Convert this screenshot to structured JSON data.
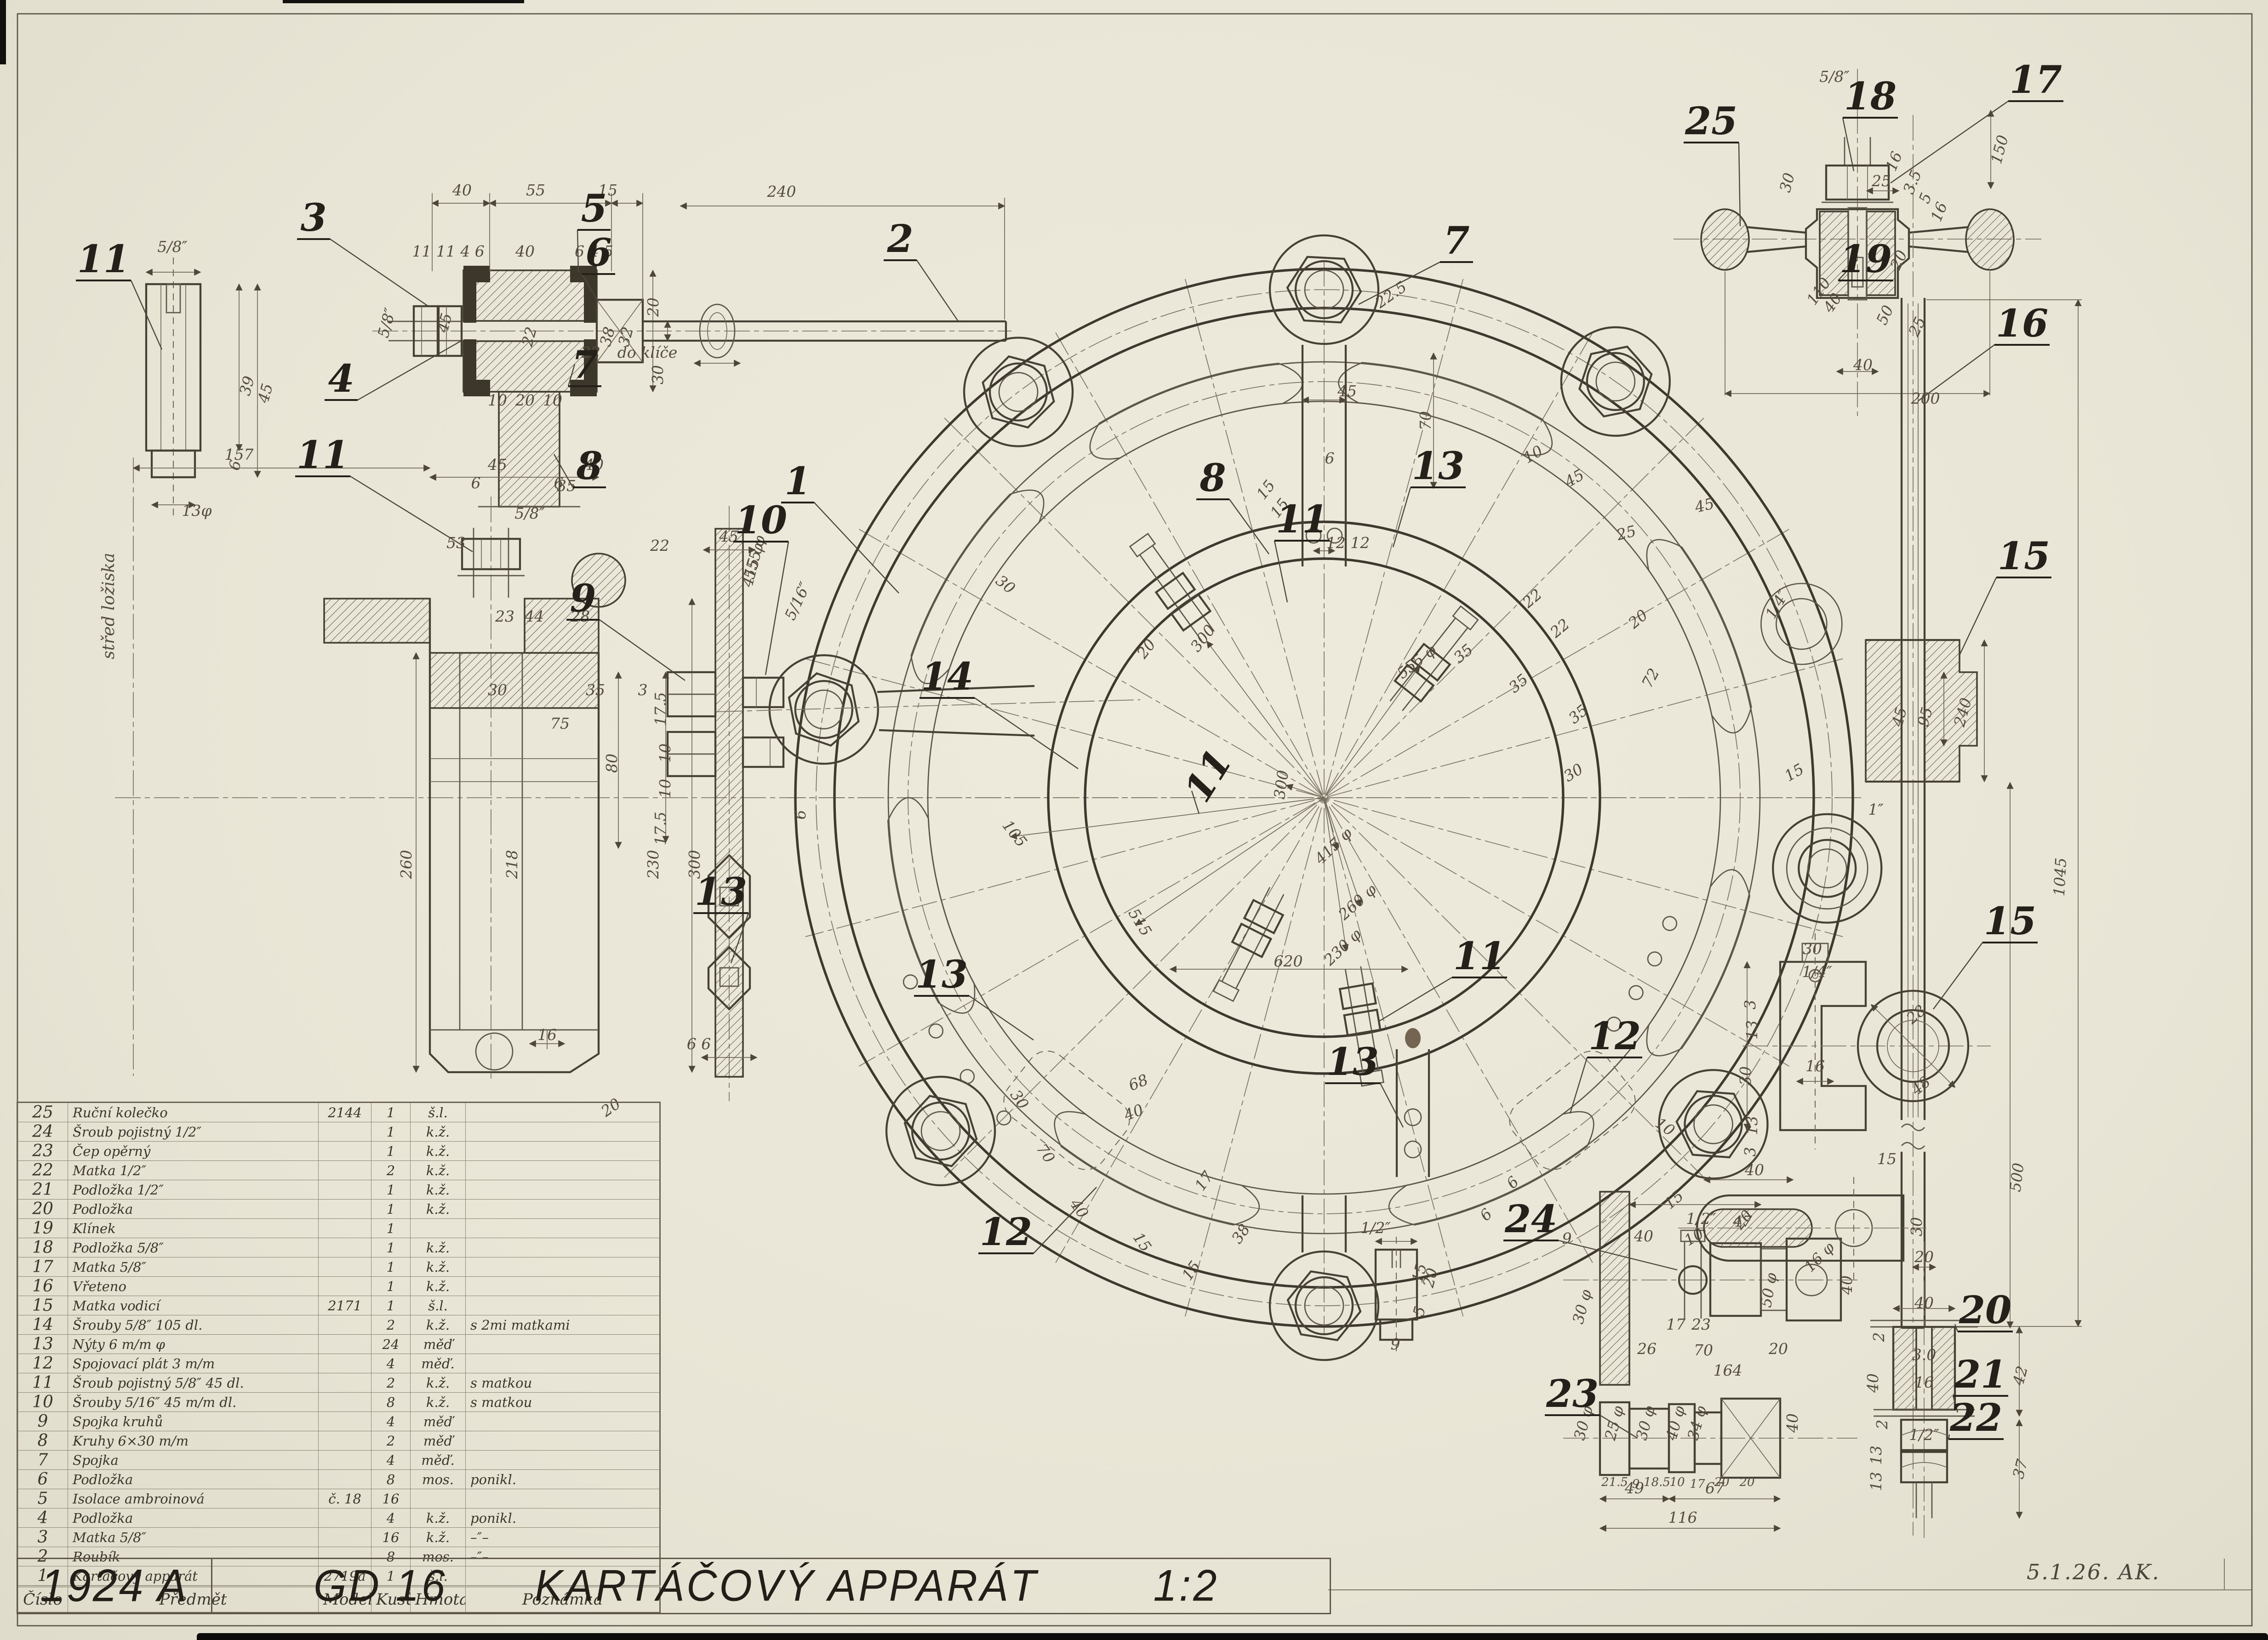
{
  "sheet": {
    "drawing_number": "1924 A",
    "model_code": "GD 16",
    "title": "KARTÁČOVÝ APPARÁT",
    "scale": "1:2",
    "signature": "5.1.26. AK."
  },
  "table": {
    "headers": [
      "Číslo",
      "Předmět",
      "Model",
      "Kusů",
      "Hmota",
      "Poznámka"
    ],
    "rows": [
      [
        "25",
        "Ruční kolečko",
        "2144",
        "1",
        "š.l.",
        ""
      ],
      [
        "24",
        "Šroub pojistný  1/2″",
        "",
        "1",
        "k.ž.",
        ""
      ],
      [
        "23",
        "Čep opěrný",
        "",
        "1",
        "k.ž.",
        ""
      ],
      [
        "22",
        "Matka  1/2″",
        "",
        "2",
        "k.ž.",
        ""
      ],
      [
        "21",
        "Podložka  1/2″",
        "",
        "1",
        "k.ž.",
        ""
      ],
      [
        "20",
        "Podložka",
        "",
        "1",
        "k.ž.",
        ""
      ],
      [
        "19",
        "Klínek",
        "",
        "1",
        "",
        ""
      ],
      [
        "18",
        "Podložka  5/8″",
        "",
        "1",
        "k.ž.",
        ""
      ],
      [
        "17",
        "Matka  5/8″",
        "",
        "1",
        "k.ž.",
        ""
      ],
      [
        "16",
        "Vřeteno",
        "",
        "1",
        "k.ž.",
        ""
      ],
      [
        "15",
        "Matka vodicí",
        "2171",
        "1",
        "š.l.",
        ""
      ],
      [
        "14",
        "Šrouby  5/8″  105 dl.",
        "",
        "2",
        "k.ž.",
        "s 2mi matkami"
      ],
      [
        "13",
        "Nýty  6 m/m φ",
        "",
        "24",
        "měď",
        ""
      ],
      [
        "12",
        "Spojovací plát  3 m/m",
        "",
        "4",
        "měď.",
        ""
      ],
      [
        "11",
        "Šroub pojistný  5/8″  45 dl.",
        "",
        "2",
        "k.ž.",
        "s matkou"
      ],
      [
        "10",
        "Šrouby  5/16″  45 m/m dl.",
        "",
        "8",
        "k.ž.",
        "s matkou"
      ],
      [
        "9",
        "Spojka kruhů",
        "",
        "4",
        "měď",
        ""
      ],
      [
        "8",
        "Kruhy  6×30 m/m",
        "",
        "2",
        "měď",
        ""
      ],
      [
        "7",
        "Spojka",
        "",
        "4",
        "měď.",
        ""
      ],
      [
        "6",
        "Podložka",
        "",
        "8",
        "mos.",
        "ponikl."
      ],
      [
        "5",
        "Isolace ambroinová",
        "č. 18",
        "16",
        "",
        ""
      ],
      [
        "4",
        "Podložka",
        "",
        "4",
        "k.ž.",
        "ponikl."
      ],
      [
        "3",
        "Matka  5/8″",
        "",
        "16",
        "k.ž.",
        "–″–"
      ],
      [
        "2",
        "Roubík",
        "",
        "8",
        "mos.",
        "–″–"
      ],
      [
        "1",
        "Kartáčový apparát",
        "2719a",
        "1",
        "š.l.",
        ""
      ]
    ]
  },
  "callouts": [
    [
      "11",
      225,
      592,
      0,
      352,
      760
    ],
    [
      "3",
      682,
      502,
      0,
      930,
      665
    ],
    [
      "5",
      1292,
      482,
      0,
      1258,
      592
    ],
    [
      "6",
      1302,
      578,
      0,
      1300,
      655
    ],
    [
      "4",
      742,
      852,
      0,
      1002,
      742
    ],
    [
      "7",
      1272,
      822,
      0,
      1250,
      792
    ],
    [
      "8",
      1282,
      1042,
      0,
      1205,
      988
    ],
    [
      "2",
      1958,
      548,
      0,
      2085,
      700
    ],
    [
      "11",
      702,
      1018,
      0,
      1028,
      1200
    ],
    [
      "9",
      1268,
      1330,
      0,
      1490,
      1480
    ],
    [
      "10",
      1655,
      1160,
      0,
      1665,
      1468
    ],
    [
      "13",
      1568,
      1968,
      0,
      1590,
      2095
    ],
    [
      "1",
      1735,
      1075,
      0,
      1955,
      1290
    ],
    [
      "7",
      3168,
      552,
      0,
      2955,
      662
    ],
    [
      "8",
      2638,
      1068,
      0,
      2760,
      1205
    ],
    [
      "13",
      3128,
      1042,
      0,
      3030,
      1190
    ],
    [
      "11",
      2832,
      1158,
      0,
      2800,
      1310
    ],
    [
      "14",
      2060,
      1500,
      0,
      2345,
      1672
    ],
    [
      "13",
      2048,
      2148,
      0,
      2248,
      2262
    ],
    [
      "11",
      2652,
      1702,
      -58,
      2608,
      1770
    ],
    [
      "12",
      2188,
      2708,
      0,
      2385,
      2582
    ],
    [
      "13",
      2942,
      2338,
      0,
      3052,
      2452
    ],
    [
      "12",
      3512,
      2282,
      0,
      3415,
      2422
    ],
    [
      "11",
      3218,
      2108,
      0,
      2998,
      2222
    ],
    [
      "25",
      3722,
      292,
      0,
      3785,
      492
    ],
    [
      "18",
      4068,
      238,
      0,
      4032,
      372
    ],
    [
      "17",
      4428,
      202,
      0,
      4112,
      398
    ],
    [
      "19",
      4058,
      592,
      0,
      4040,
      565
    ],
    [
      "16",
      4398,
      732,
      0,
      4172,
      872
    ],
    [
      "15",
      4402,
      1238,
      0,
      4262,
      1425
    ],
    [
      "15",
      4372,
      2032,
      0,
      4205,
      2195
    ],
    [
      "24",
      3330,
      2680,
      0,
      3648,
      2762
    ],
    [
      "23",
      3420,
      3060,
      0,
      3562,
      3128
    ],
    [
      "20",
      4318,
      2878,
      0,
      4252,
      2880
    ],
    [
      "21",
      4308,
      3018,
      0,
      4258,
      3072
    ],
    [
      "22",
      4298,
      3112,
      0,
      4240,
      3120
    ]
  ],
  "dims": [
    [
      "40",
      1005,
      425,
      0
    ],
    [
      "55",
      1165,
      425,
      0
    ],
    [
      "15",
      1322,
      425,
      0
    ],
    [
      "11 11 4 6",
      975,
      558,
      0
    ],
    [
      "40",
      1142,
      558,
      0
    ],
    [
      "6 4 5",
      1292,
      558,
      0
    ],
    [
      "5/8″",
      852,
      705,
      -75
    ],
    [
      "45",
      978,
      705,
      -75
    ],
    [
      "22",
      1162,
      735,
      -75
    ],
    [
      "38",
      1332,
      735,
      -75
    ],
    [
      "32",
      1372,
      735,
      -75
    ],
    [
      "30",
      1442,
      815,
      -90
    ],
    [
      "10",
      1082,
      882,
      0
    ],
    [
      "20",
      1142,
      882,
      0
    ],
    [
      "10",
      1202,
      882,
      0
    ],
    [
      "6",
      1035,
      1062,
      0
    ],
    [
      "6",
      1215,
      1062,
      0
    ],
    [
      "5/8″",
      375,
      548,
      0
    ],
    [
      "39",
      548,
      842,
      -75
    ],
    [
      "45",
      588,
      858,
      -75
    ],
    [
      "6",
      522,
      1015,
      -75
    ],
    [
      "13φ",
      428,
      1122,
      0
    ],
    [
      "240",
      1700,
      428,
      0
    ],
    [
      "20",
      1432,
      668,
      -90
    ],
    [
      "22",
      1285,
      778,
      0
    ],
    [
      "do klíče",
      1408,
      778,
      0
    ],
    [
      "157",
      520,
      1000,
      0
    ],
    [
      "45",
      1082,
      1022,
      0
    ],
    [
      "40",
      1292,
      1022,
      0
    ],
    [
      "35",
      1232,
      1068,
      0
    ],
    [
      "5/8″",
      1152,
      1128,
      0
    ],
    [
      "53",
      992,
      1192,
      0
    ],
    [
      "22",
      1435,
      1198,
      0
    ],
    [
      "23",
      1098,
      1352,
      0
    ],
    [
      "44",
      1162,
      1352,
      0
    ],
    [
      "28",
      1262,
      1352,
      0
    ],
    [
      "30",
      1082,
      1512,
      0
    ],
    [
      "35",
      1295,
      1512,
      0
    ],
    [
      "3",
      1398,
      1512,
      0
    ],
    [
      "75",
      1218,
      1585,
      0
    ],
    [
      "260",
      895,
      1880,
      -90
    ],
    [
      "218",
      1125,
      1880,
      -90
    ],
    [
      "230",
      1432,
      1880,
      -90
    ],
    [
      "300",
      1522,
      1880,
      -90
    ],
    [
      "16",
      1190,
      2262,
      0
    ],
    [
      "20",
      1335,
      2418,
      -35
    ],
    [
      "415 φ",
      1648,
      1232,
      -75
    ],
    [
      "střed ložiska",
      248,
      1318,
      -90,
      36
    ],
    [
      "45",
      1585,
      1178,
      0
    ],
    [
      "5/16″",
      1745,
      1312,
      -65
    ],
    [
      "17.5",
      1448,
      1542,
      -90
    ],
    [
      "10",
      1458,
      1638,
      -90
    ],
    [
      "10",
      1458,
      1715,
      -90
    ],
    [
      "17.5",
      1448,
      1802,
      -90
    ],
    [
      "80",
      1342,
      1660,
      -90
    ],
    [
      "6",
      1752,
      1772,
      -90
    ],
    [
      "6 6",
      1520,
      2282,
      0
    ],
    [
      "45",
      2930,
      862,
      0
    ],
    [
      "70",
      3112,
      915,
      -90
    ],
    [
      "6",
      2892,
      1008,
      0
    ],
    [
      "15",
      2762,
      1072,
      -52
    ],
    [
      "15",
      2792,
      1112,
      -52
    ],
    [
      "12 12",
      2932,
      1192,
      0
    ],
    [
      "22.5",
      3032,
      650,
      -35
    ],
    [
      "30",
      2180,
      1280,
      38
    ],
    [
      "20",
      2502,
      1418,
      -52
    ],
    [
      "300",
      2625,
      1395,
      -52
    ],
    [
      "300",
      2798,
      1708,
      -82
    ],
    [
      "555 φ",
      3088,
      1448,
      -38
    ],
    [
      "415 φ",
      2908,
      1848,
      -44
    ],
    [
      "260 φ",
      2960,
      1970,
      -42
    ],
    [
      "230 φ",
      2928,
      2068,
      -44
    ],
    [
      "620",
      2802,
      2102,
      0
    ],
    [
      "515",
      2470,
      2012,
      58
    ],
    [
      "105",
      2198,
      1820,
      52
    ],
    [
      "555 φ",
      1652,
      1215,
      -75
    ],
    [
      "35",
      3190,
      1430,
      -40
    ],
    [
      "35",
      3310,
      1495,
      -40
    ],
    [
      "35",
      3440,
      1562,
      -40
    ],
    [
      "22",
      3340,
      1310,
      -40
    ],
    [
      "22",
      3400,
      1375,
      -40
    ],
    [
      "72",
      3600,
      1480,
      -62
    ],
    [
      "30",
      3428,
      1690,
      -32
    ],
    [
      "20",
      3570,
      1355,
      -40
    ],
    [
      "25",
      3540,
      1170,
      -14
    ],
    [
      "45",
      3710,
      1110,
      -14
    ],
    [
      "10",
      3340,
      998,
      -30
    ],
    [
      "45",
      3430,
      1050,
      -30
    ],
    [
      "1/4″",
      3875,
      1320,
      -60
    ],
    [
      "15",
      3908,
      1690,
      -30
    ],
    [
      "68",
      2480,
      2365,
      -22
    ],
    [
      "40",
      2470,
      2430,
      -22
    ],
    [
      "70",
      2265,
      2515,
      55
    ],
    [
      "40",
      2338,
      2635,
      55
    ],
    [
      "30",
      2208,
      2398,
      55
    ],
    [
      "17",
      2628,
      2575,
      -55
    ],
    [
      "38",
      2708,
      2690,
      -55
    ],
    [
      "15",
      2600,
      2770,
      -55
    ],
    [
      "15",
      2475,
      2708,
      55
    ],
    [
      "6",
      3298,
      2580,
      -45
    ],
    [
      "6",
      3240,
      2650,
      -45
    ],
    [
      "10",
      3615,
      2460,
      35
    ],
    [
      "5/8″",
      3990,
      178,
      0
    ],
    [
      "30",
      3898,
      400,
      -75
    ],
    [
      "16",
      4130,
      355,
      -68
    ],
    [
      "3.5",
      4170,
      400,
      -68
    ],
    [
      "5",
      4198,
      435,
      -68
    ],
    [
      "16",
      4228,
      465,
      -68
    ],
    [
      "20",
      4140,
      570,
      -65
    ],
    [
      "50",
      4110,
      690,
      -65
    ],
    [
      "25",
      4180,
      715,
      -65
    ],
    [
      "110",
      3965,
      640,
      -55
    ],
    [
      "40",
      3995,
      665,
      -55
    ],
    [
      "40",
      4052,
      805,
      0
    ],
    [
      "200",
      4188,
      878,
      0
    ],
    [
      "150",
      4360,
      328,
      -75
    ],
    [
      "25",
      4092,
      405,
      0
    ],
    [
      "1045",
      4492,
      1908,
      -87
    ],
    [
      "500",
      4398,
      2562,
      -83
    ],
    [
      "1″",
      4080,
      1772,
      0
    ],
    [
      "45",
      4142,
      1562,
      -75
    ],
    [
      "95",
      4198,
      1562,
      -75
    ],
    [
      "240",
      4280,
      1552,
      -75
    ],
    [
      "30",
      3942,
      2075,
      0
    ],
    [
      "1/4″",
      3952,
      2125,
      0
    ],
    [
      "3",
      3818,
      2185,
      -90
    ],
    [
      "13",
      3822,
      2240,
      -90
    ],
    [
      "30",
      3808,
      2340,
      -90
    ],
    [
      "13",
      3822,
      2448,
      -90
    ],
    [
      "3",
      3818,
      2505,
      -90
    ],
    [
      "16",
      3948,
      2330,
      0
    ],
    [
      "28",
      4175,
      2215,
      -40
    ],
    [
      "48",
      4185,
      2370,
      -40
    ],
    [
      "9",
      3408,
      2705,
      0
    ],
    [
      "40",
      3575,
      2700,
      0
    ],
    [
      "1/2″",
      3700,
      2662,
      0
    ],
    [
      "47",
      3790,
      2668,
      0
    ],
    [
      "30 φ",
      3452,
      2845,
      -75
    ],
    [
      "50 φ",
      3858,
      2808,
      -80
    ],
    [
      "17",
      3645,
      2892,
      0
    ],
    [
      "23",
      3700,
      2892,
      0
    ],
    [
      "16 φ",
      3965,
      2742,
      -45
    ],
    [
      "40",
      4028,
      2795,
      -90
    ],
    [
      "26",
      3582,
      2945,
      0
    ],
    [
      "70",
      3705,
      2948,
      0
    ],
    [
      "20",
      3868,
      2945,
      0
    ],
    [
      "164",
      3758,
      2992,
      0
    ],
    [
      "30 φ",
      3455,
      3098,
      -75
    ],
    [
      "25 φ",
      3522,
      3098,
      -75
    ],
    [
      "30 φ",
      3590,
      3098,
      -75
    ],
    [
      "40 φ",
      3655,
      3098,
      -75
    ],
    [
      "34 φ",
      3702,
      3098,
      -75
    ],
    [
      "40",
      3910,
      3095,
      -90
    ],
    [
      "21.5",
      3512,
      3232,
      0,
      26
    ],
    [
      "9",
      3558,
      3236,
      0,
      26
    ],
    [
      "18.5",
      3604,
      3232,
      0,
      26
    ],
    [
      "10",
      3648,
      3232,
      0,
      26
    ],
    [
      "17",
      3692,
      3236,
      0,
      26
    ],
    [
      "20",
      3745,
      3232,
      0,
      26
    ],
    [
      "20",
      3800,
      3232,
      0,
      26
    ],
    [
      "49",
      3555,
      3248,
      0
    ],
    [
      "67",
      3730,
      3248,
      0
    ],
    [
      "116",
      3660,
      3312,
      0
    ],
    [
      "1/2″",
      2992,
      2682,
      0
    ],
    [
      "15",
      3098,
      2772,
      -75
    ],
    [
      "20",
      3122,
      2782,
      -75
    ],
    [
      "5",
      3098,
      2855,
      -75
    ],
    [
      "9",
      3035,
      2935,
      0
    ],
    [
      "40",
      3816,
      2556,
      0
    ],
    [
      "15",
      4104,
      2532,
      0
    ],
    [
      "20",
      3800,
      2660,
      -50
    ],
    [
      "10",
      3690,
      2700,
      -30
    ],
    [
      "30",
      4180,
      2668,
      -90
    ],
    [
      "15",
      3648,
      2618,
      -40
    ],
    [
      "20",
      4185,
      2745,
      0
    ],
    [
      "40",
      4185,
      2845,
      0
    ],
    [
      "2",
      4098,
      2908,
      -90
    ],
    [
      "3.0",
      4185,
      2958,
      0
    ],
    [
      "16",
      4185,
      3018,
      0
    ],
    [
      "40",
      4085,
      3008,
      -90
    ],
    [
      "2",
      4105,
      3098,
      -90
    ],
    [
      "13",
      4092,
      3165,
      -90
    ],
    [
      "13",
      4092,
      3222,
      -90
    ],
    [
      "1/2″",
      4185,
      3132,
      0
    ],
    [
      "42",
      4405,
      2995,
      -75
    ],
    [
      "37",
      4405,
      3198,
      -75
    ]
  ]
}
